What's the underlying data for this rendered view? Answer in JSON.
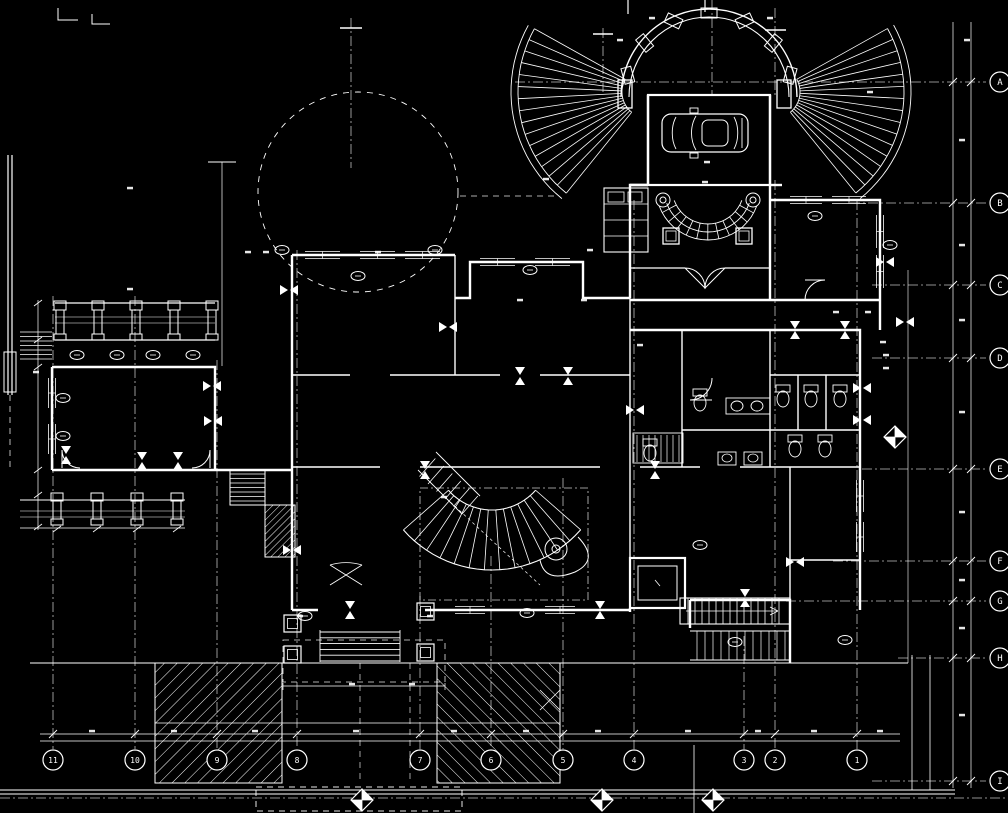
{
  "meta": {
    "drawing_type": "architectural-floor-plan",
    "background_color": "#000000",
    "line_color": "#ffffff"
  },
  "grid": {
    "rows": [
      {
        "label": "A",
        "y": 82,
        "line_from": 515
      },
      {
        "label": "B",
        "y": 203,
        "line_from": 850
      },
      {
        "label": "C",
        "y": 285,
        "line_from": 872
      },
      {
        "label": "D",
        "y": 358,
        "line_from": 872
      },
      {
        "label": "E",
        "y": 469,
        "line_from": 862
      },
      {
        "label": "F",
        "y": 561,
        "line_from": 833
      },
      {
        "label": "G",
        "y": 601,
        "line_from": 786
      },
      {
        "label": "H",
        "y": 658,
        "line_from": 898
      },
      {
        "label": "I",
        "y": 781,
        "line_from": 872
      }
    ],
    "cols": [
      {
        "label": "11",
        "x": 53,
        "line_from": 296
      },
      {
        "label": "10",
        "x": 135,
        "line_from": 296
      },
      {
        "label": "9",
        "x": 217,
        "line_from": 360
      },
      {
        "label": "8",
        "x": 297,
        "line_from": 250
      },
      {
        "label": "7",
        "x": 420,
        "line_from": 596
      },
      {
        "label": "6",
        "x": 491,
        "line_from": 556
      },
      {
        "label": "5",
        "x": 563,
        "line_from": 478
      },
      {
        "label": "4",
        "x": 634,
        "line_from": 200
      },
      {
        "label": "3",
        "x": 744,
        "line_from": 636
      },
      {
        "label": "2",
        "x": 775,
        "line_from": 180
      },
      {
        "label": "1",
        "x": 857,
        "line_from": 200
      }
    ]
  },
  "section_markers": [
    {
      "x": 362,
      "y": 800
    },
    {
      "x": 602,
      "y": 800
    },
    {
      "x": 713,
      "y": 800
    },
    {
      "x": 895,
      "y": 437
    }
  ]
}
